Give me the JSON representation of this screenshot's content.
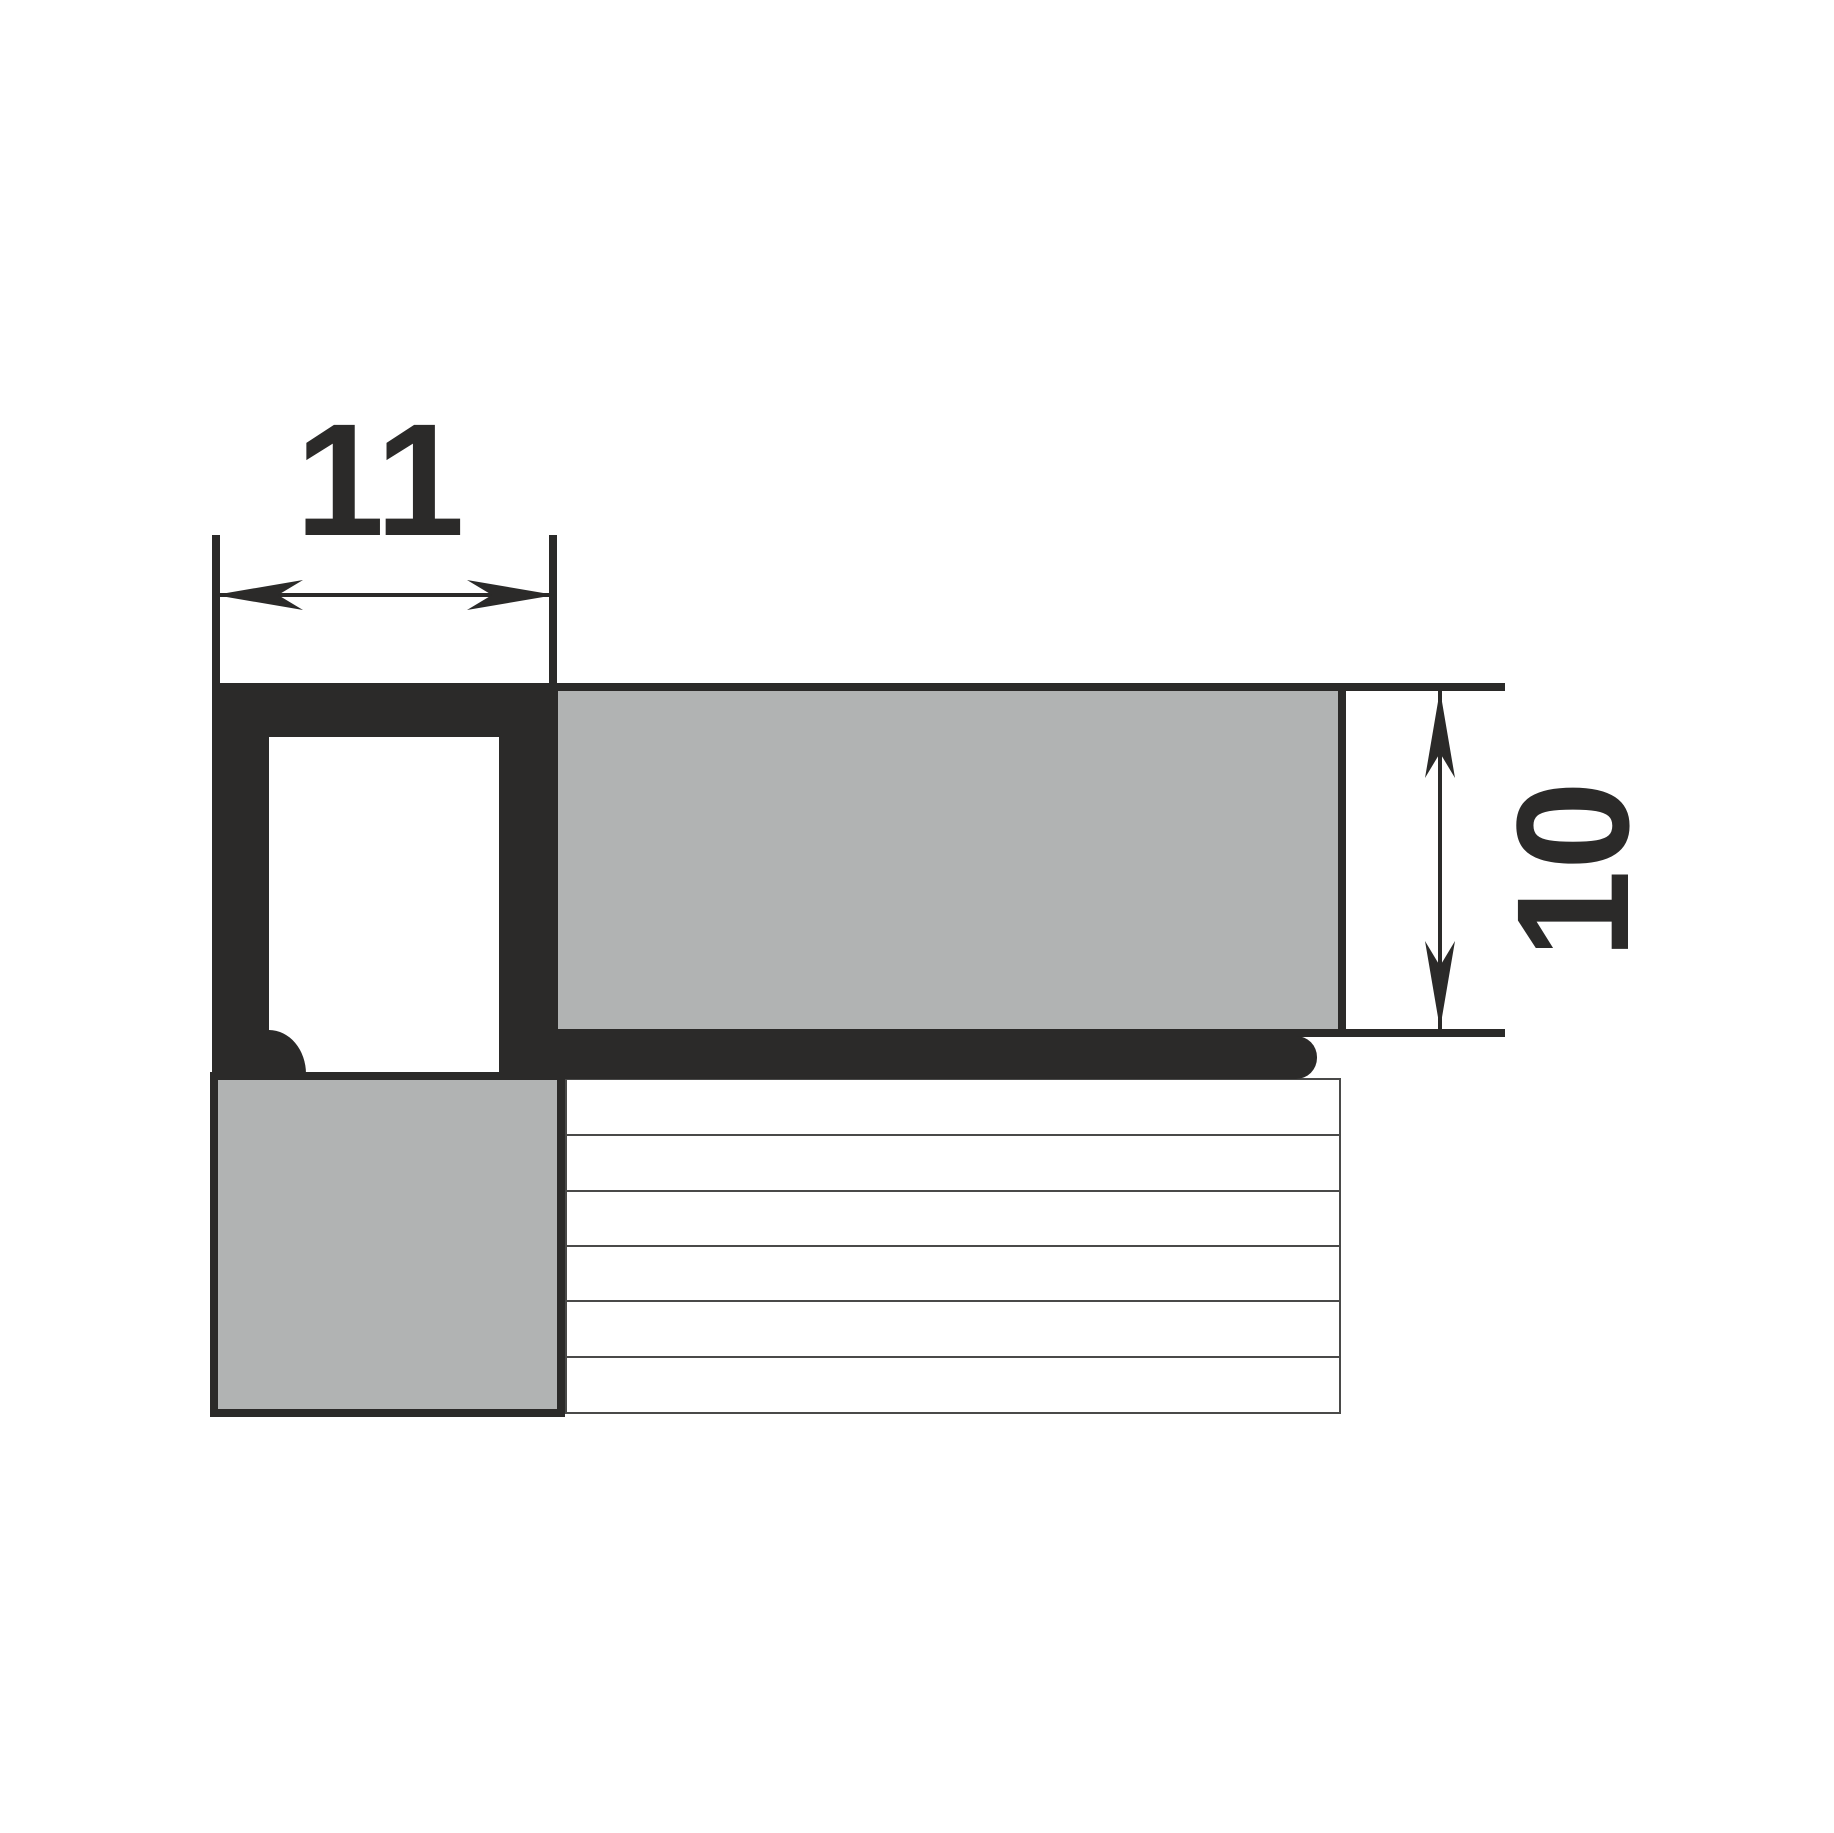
{
  "drawing": {
    "kind": "tile-edge-profile-cross-section"
  },
  "dimensions": {
    "width": {
      "label": "11"
    },
    "height": {
      "label": "10"
    }
  },
  "hatch": {
    "bands": 6
  },
  "colors": {
    "ink": "#2b2a29",
    "tile-fill": "#b1b3b3",
    "hatch-line": "#4a4a49",
    "background": "#ffffff"
  }
}
